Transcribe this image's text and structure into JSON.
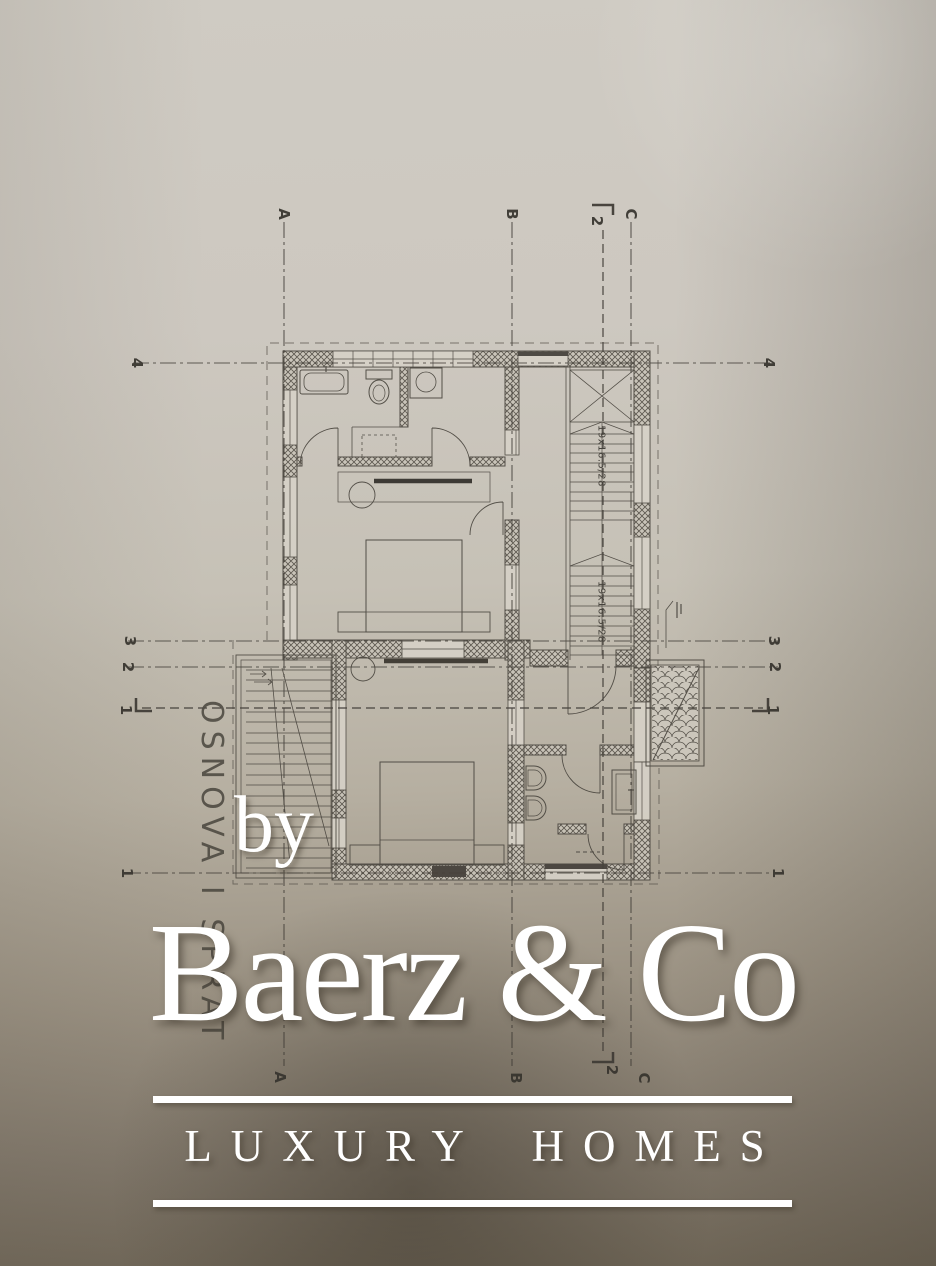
{
  "brand": {
    "by": "by",
    "name": "Baerz & Co",
    "tagline": "LUXURY HOMES",
    "color": "#ffffff"
  },
  "plan": {
    "title": "OSNOVA I SPRAT",
    "stair_labels": {
      "upper": "19x16.5/28",
      "lower": "19x16.5/28"
    },
    "grid": {
      "top": {
        "a": "A",
        "b": "B",
        "s2": "2",
        "c": "C"
      },
      "bottom": {
        "a": "A",
        "b": "B",
        "s2": "2",
        "c": "C"
      },
      "left": {
        "r4": "4",
        "r3": "3",
        "r2": "2",
        "s1": "1",
        "r1": "1"
      },
      "right": {
        "r4": "4",
        "r3": "3",
        "r2": "2",
        "s1": "1",
        "r1": "1"
      }
    }
  },
  "colors": {
    "paper": "#cfcbc3",
    "paper_shadow": "#6d6455",
    "ink": "#403c35",
    "watermark": "#ffffff"
  }
}
